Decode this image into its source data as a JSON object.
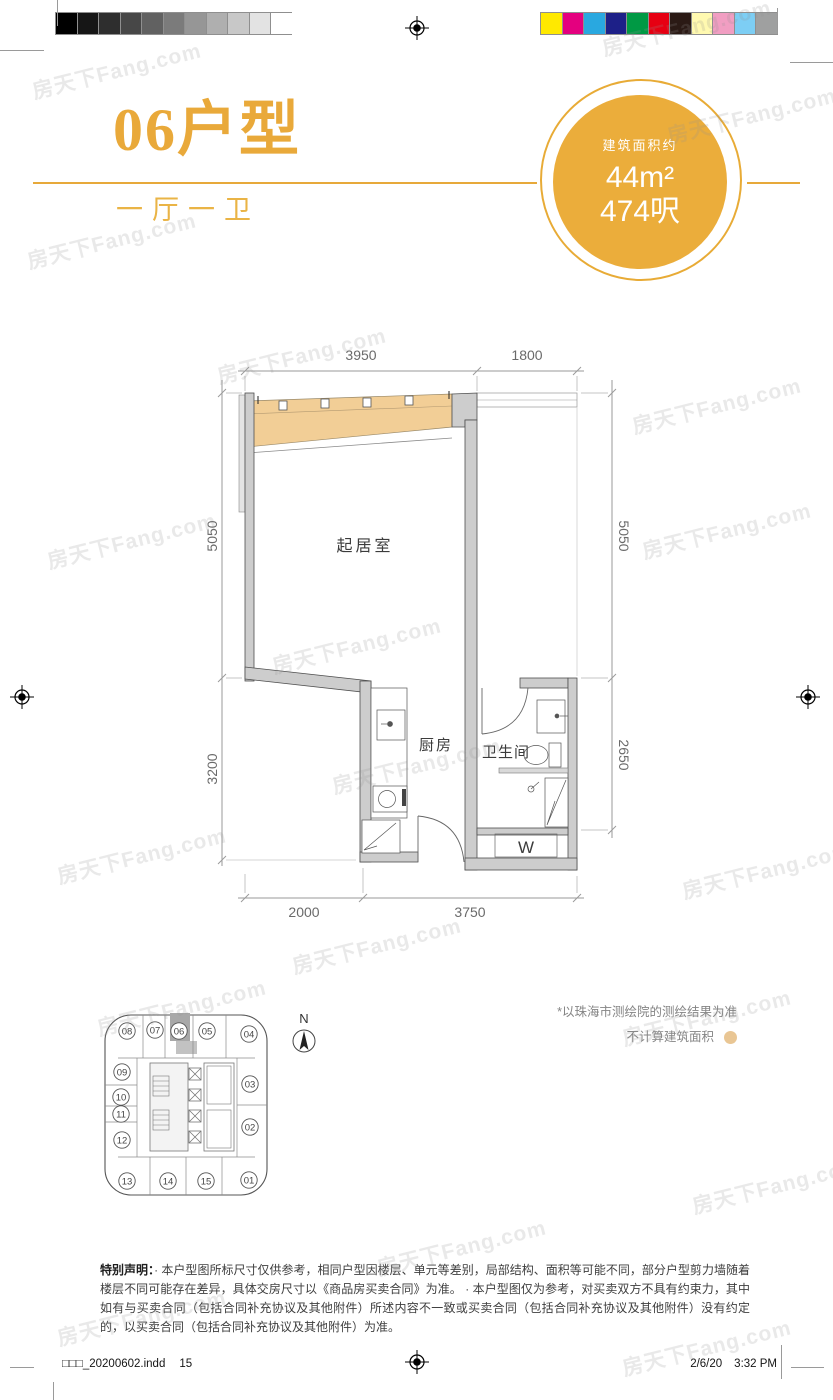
{
  "watermark": "房天下Fang.com",
  "header": {
    "title": "06户型",
    "subtitle": "一厅一卫",
    "area_label": "建筑面积约",
    "area_m2": "44m²",
    "area_ft": "474呎"
  },
  "plan": {
    "rooms": {
      "living": "起居室",
      "kitchen": "厨房",
      "bath": "卫生间",
      "washer": "W"
    },
    "dims": {
      "top_left": "3950",
      "top_right": "1800",
      "left_upper": "5050",
      "left_lower": "3200",
      "right_upper": "5050",
      "right_lower": "2650",
      "bottom_left": "2000",
      "bottom_right": "3750"
    }
  },
  "keyplan": {
    "units": [
      "08",
      "07",
      "06",
      "05",
      "04",
      "09",
      "10",
      "11",
      "12",
      "03",
      "02",
      "13",
      "14",
      "15",
      "01"
    ],
    "highlight": "06",
    "north": "N"
  },
  "notes": {
    "survey": "*以珠海市测绘院的测绘结果为准",
    "exclude": "不计算建筑面积"
  },
  "disclaimer": {
    "label": "特别声明：",
    "text": "· 本户型图所标尺寸仅供参考，相同户型因楼层、单元等差别，局部结构、面积等可能不同，部分户型剪力墙随着楼层不同可能存在差异，具体交房尺寸以《商品房买卖合同》为准。 · 本户型图仅为参考，对买卖双方不具有约束力，其中如有与买卖合同（包括合同补充协议及其他附件）所述内容不一致或买卖合同（包括合同补充协议及其他附件）没有约定的，以买卖合同（包括合同补充协议及其他附件）为准。"
  },
  "footer": {
    "file": "□□□_20200602.indd",
    "page": "15",
    "date": "2/6/20",
    "time": "3:32 PM"
  },
  "colors": {
    "gold": "#e9a93a",
    "tan": "#f2ce96",
    "legend_dot": "#e9c694",
    "wall_fill": "#cdcdcd"
  },
  "calibration": {
    "grays": [
      "#000000",
      "#161616",
      "#2e2e2e",
      "#474747",
      "#616161",
      "#7b7b7b",
      "#969696",
      "#afafaf",
      "#c8c8c8",
      "#e3e3e3",
      "#ffffff"
    ],
    "colors": [
      "#ffe900",
      "#e4007f",
      "#29a8e0",
      "#1d2088",
      "#009944",
      "#e60012",
      "#2b1a15",
      "#fff9b0",
      "#f19ec2",
      "#7dcef4",
      "#9fa0a0"
    ]
  }
}
